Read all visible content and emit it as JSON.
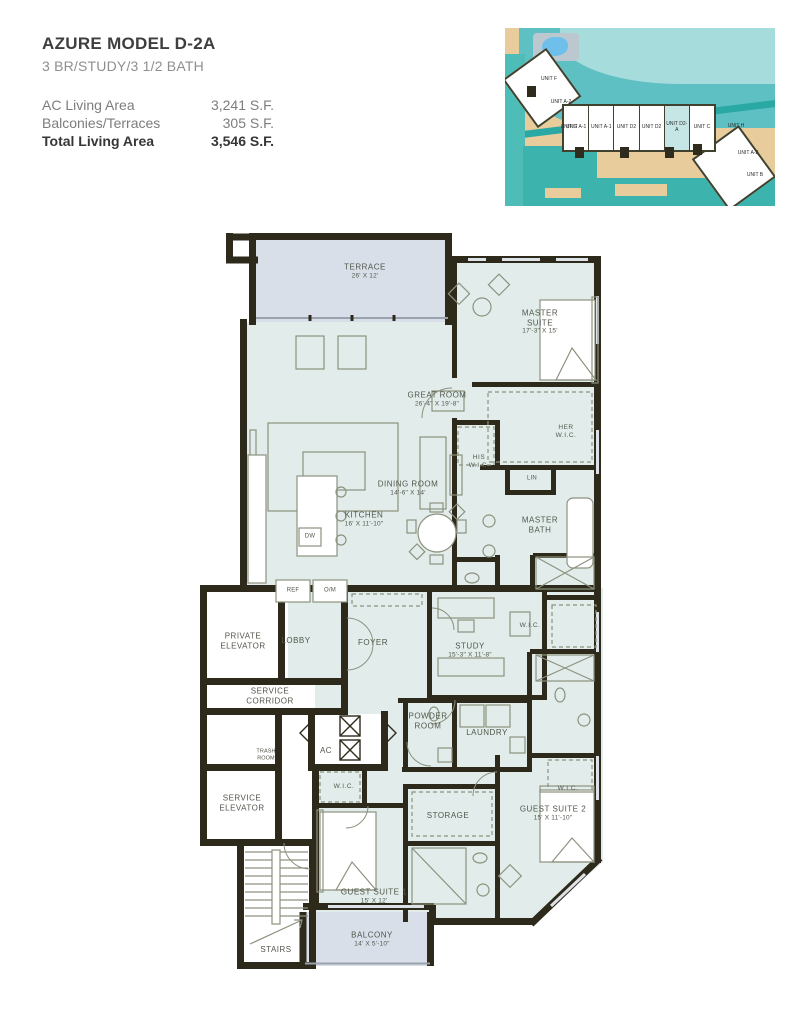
{
  "header": {
    "title": "AZURE MODEL D-2A",
    "subtitle": "3 BR/STUDY/3 1/2 BATH",
    "areas": [
      {
        "label": "AC Living Area",
        "value": "3,241 S.F."
      },
      {
        "label": "Balconies/Terraces",
        "value": "305 S.F."
      },
      {
        "label": "Total Living Area",
        "value": "3,546 S.F."
      }
    ]
  },
  "siteplan": {
    "units": [
      {
        "label": "UNIT F"
      },
      {
        "label": "UNIT A-2"
      },
      {
        "label": "UNIT G"
      },
      {
        "label": "UNIT A-1"
      },
      {
        "label": "UNIT A-1"
      },
      {
        "label": "UNIT D2"
      },
      {
        "label": "UNIT D2"
      },
      {
        "label": "UNIT D2-A"
      },
      {
        "label": "UNIT C"
      },
      {
        "label": "UNIT H"
      },
      {
        "label": "UNIT A-2"
      },
      {
        "label": "UNIT B"
      }
    ],
    "highlighted_unit": "UNIT D2-A"
  },
  "plan": {
    "labels": [
      {
        "name": "TERRACE",
        "dims": "26' X 12'"
      },
      {
        "name": "MASTER SUITE",
        "dims": "17'-3\" X 15'"
      },
      {
        "name": "GREAT ROOM",
        "dims": "26'-4\" X 19'-8\""
      },
      {
        "name": "DINING ROOM",
        "dims": "14'-6\" X 14'"
      },
      {
        "name": "KITCHEN",
        "dims": "16' X 11'-10\""
      },
      {
        "name": "HIS W.I.C."
      },
      {
        "name": "HER W.I.C."
      },
      {
        "name": "LIN"
      },
      {
        "name": "MASTER BATH"
      },
      {
        "name": "REF"
      },
      {
        "name": "O/M"
      },
      {
        "name": "DW"
      },
      {
        "name": "PRIVATE ELEVATOR"
      },
      {
        "name": "LOBBY"
      },
      {
        "name": "FOYER"
      },
      {
        "name": "SERVICE CORRIDOR"
      },
      {
        "name": "TRASH ROOM"
      },
      {
        "name": "AC"
      },
      {
        "name": "SERVICE ELEVATOR"
      },
      {
        "name": "STAIRS"
      },
      {
        "name": "STUDY",
        "dims": "15'-3\" X 11'-8\""
      },
      {
        "name": "W.I.C."
      },
      {
        "name": "POWDER ROOM"
      },
      {
        "name": "LAUNDRY"
      },
      {
        "name": "W.I.C."
      },
      {
        "name": "STORAGE"
      },
      {
        "name": "W.I.C."
      },
      {
        "name": "GUEST SUITE 2",
        "dims": "15' X 11'-10\""
      },
      {
        "name": "GUEST SUITE 1",
        "dims": "15' X 12'"
      },
      {
        "name": "BALCONY",
        "dims": "14' X 5'-10\""
      }
    ]
  },
  "colors": {
    "wall": "#2e2a1b",
    "interior_fill": "#e2edeb",
    "terrace_fill": "#d8dfe9",
    "water": "#5ec0c2",
    "sand": "#e8cc9c",
    "highlight_unit_fill": "#c6e6e6"
  }
}
